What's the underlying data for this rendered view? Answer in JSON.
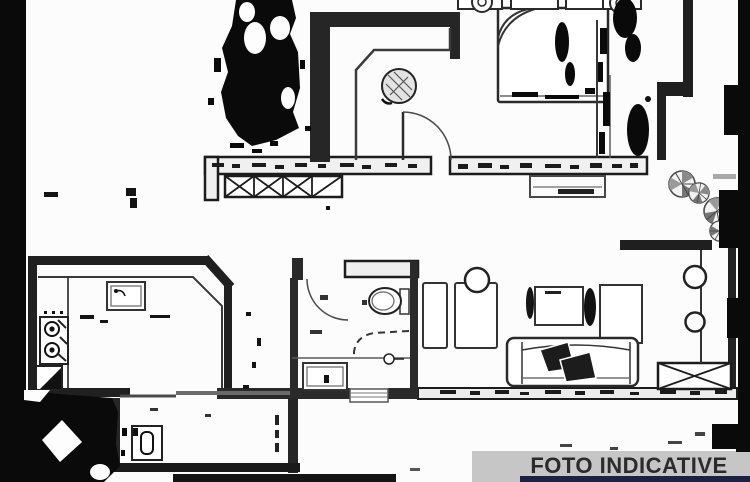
{
  "image": {
    "width": 750,
    "height": 482,
    "background": "#fcfcfc",
    "kind": "scanned apartment floor plan photo"
  },
  "banner": {
    "label": "FOTO INDICATIVE",
    "bg_color": "#c6c6c6",
    "text_color": "#2b2b2e",
    "strip_color": "#1c2342",
    "corner_block_color": "#0b0b0b"
  },
  "plan": {
    "ink_color": "#1f1f1f",
    "wall_fill": "#efefef",
    "artifact_color": "#0a0a0a",
    "symbols": {
      "double-bed-icon": "bed rectangle with folded corner and two pillows",
      "nightstand-lamp-icon": "small table with round lamp",
      "round-table-icon": "hatched circle",
      "door-swing-icon": "quarter-circle arc with leaf line",
      "radiator-icon": "rectangle with X cross hatching",
      "window-icon": "double-line rectangle in wall",
      "plant-icon": "circle with pinwheel sectors",
      "stove-icon": "counter unit with two burner rings",
      "kitchen-sink-icon": "double rectangle with faucet dot",
      "toilet-icon": "oval bowl with cistern",
      "shower-icon": "dashed quarter enclosure with drain circle",
      "bath-sink-icon": "double rectangle basin",
      "sofa-icon": "long seat with armrests and dark throw",
      "tv-cabinet-icon": "rectangles along wall",
      "shelf-circles-icon": "two circles on a line",
      "washing-machine-icon": "square with rounded door",
      "scan-noise-icon": "black blob artifacts"
    }
  }
}
